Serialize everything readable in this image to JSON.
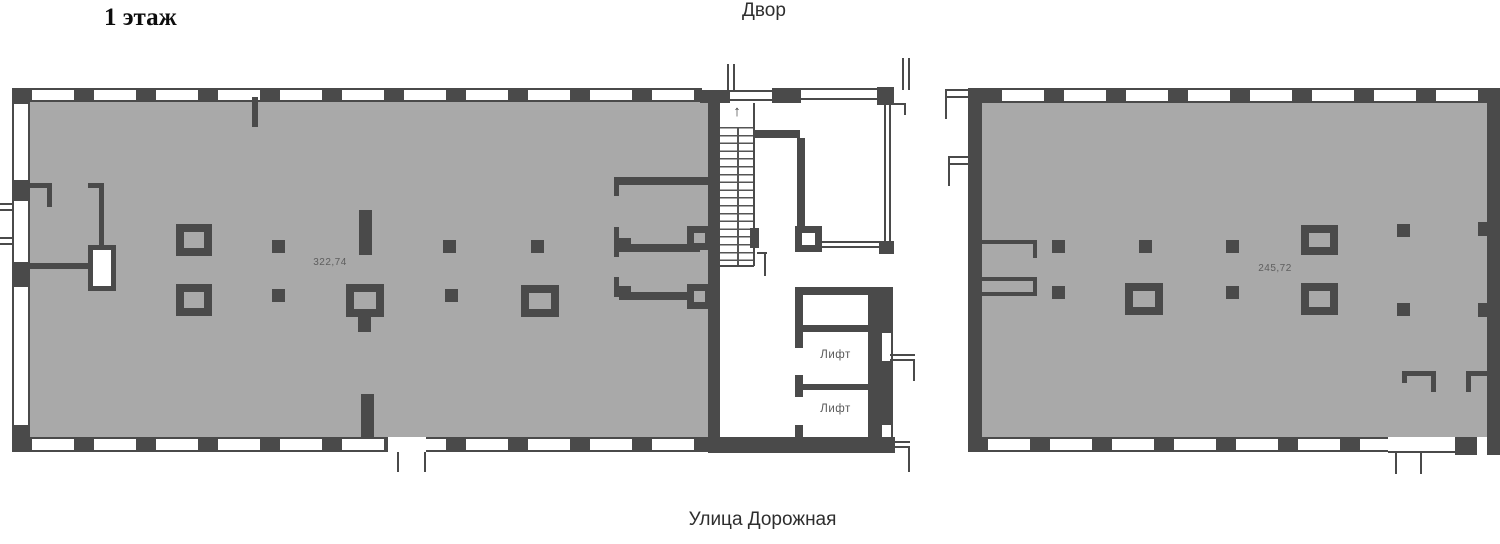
{
  "page": {
    "floor_title": "1 этаж",
    "courtyard_label": "Двор",
    "street_label": "Улица Дорожная"
  },
  "units": {
    "left": {
      "area": "322,74"
    },
    "right": {
      "area": "245,72"
    }
  },
  "core": {
    "elevators": [
      "Лифт",
      "Лифт"
    ],
    "stair_arrow": "↑"
  },
  "colors": {
    "floor": "#a9a9a9",
    "wall": "#4a4a4a",
    "line": "#5a5a5a",
    "text": "#2e2e2e",
    "dim": "#5e5e5e"
  }
}
